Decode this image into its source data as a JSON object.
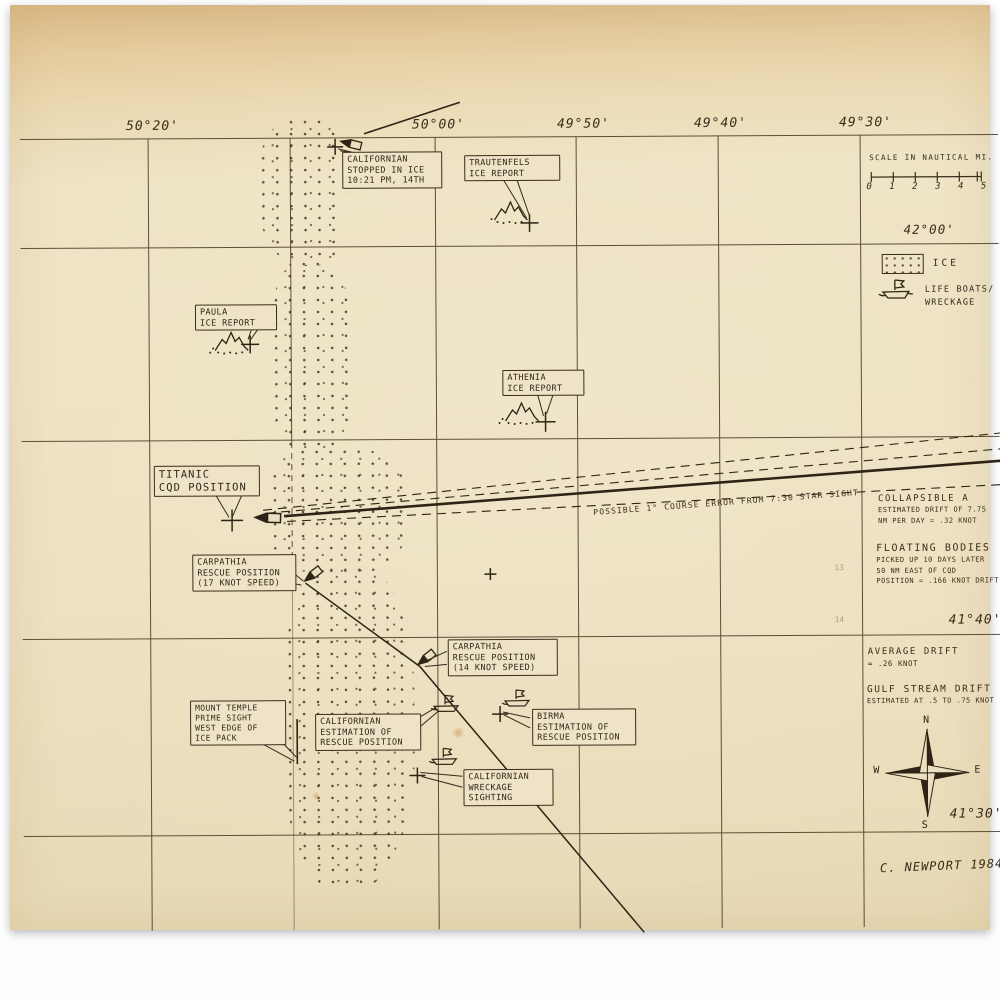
{
  "longitude_labels": [
    "50°20'",
    "50°00'",
    "49°50'",
    "49°40'",
    "49°30'"
  ],
  "latitude_labels": [
    "42°00'",
    "41°40'",
    "41°30'"
  ],
  "scale": {
    "title": "SCALE IN NAUTICAL MI.",
    "ticks": [
      "0",
      "1",
      "2",
      "3",
      "4",
      "5"
    ]
  },
  "legend": {
    "ice": "ICE",
    "lifeboats": [
      "LIFE BOATS/",
      "WRECKAGE"
    ]
  },
  "callouts": {
    "californian_stopped": [
      "CALIFORNIAN",
      "STOPPED IN ICE",
      "10:21 PM, 14TH"
    ],
    "trautenfels": [
      "TRAUTENFELS",
      "ICE REPORT"
    ],
    "paula": [
      "PAULA",
      "ICE REPORT"
    ],
    "athenia": [
      "ATHENIA",
      "ICE REPORT"
    ],
    "titanic": [
      "TITANIC",
      "CQD POSITION"
    ],
    "carpathia_17": [
      "CARPATHIA",
      "RESCUE POSITION",
      "(17 KNOT SPEED)"
    ],
    "carpathia_14": [
      "CARPATHIA",
      "RESCUE POSITION",
      "(14 KNOT SPEED)"
    ],
    "mount_temple": [
      "MOUNT TEMPLE",
      "PRIME SIGHT",
      "WEST EDGE OF",
      "ICE PACK"
    ],
    "californian_estimation": [
      "CALIFORNIAN",
      "ESTIMATION OF",
      "RESCUE POSITION"
    ],
    "birma": [
      "BIRMA",
      "ESTIMATION OF",
      "RESCUE POSITION"
    ],
    "californian_wreckage": [
      "CALIFORNIAN",
      "WRECKAGE",
      "SIGHTING"
    ]
  },
  "annotations": {
    "course_error": "POSSIBLE 1° COURSE ERROR FROM 7:30 STAR SIGHT",
    "collapsible": {
      "title": "COLLAPSIBLE A",
      "lines": [
        "ESTIMATED DRIFT OF 7.75",
        "NM PER DAY = .32 KNOT"
      ]
    },
    "floating_bodies": {
      "title": "FLOATING BODIES",
      "lines": [
        "PICKED UP 10 DAYS LATER",
        "50 NM EAST OF CQD",
        "POSITION = .166 KNOT DRIFT"
      ]
    },
    "average_drift": {
      "title": "AVERAGE DRIFT",
      "lines": [
        "= .26 KNOT"
      ]
    },
    "gulf_stream": {
      "title": "GULF STREAM DRIFT",
      "lines": [
        "ESTIMATED AT .5 TO .75 KNOT"
      ]
    },
    "pencil_marks": [
      "13",
      "14"
    ]
  },
  "compass": {
    "north": "N",
    "east": "E",
    "south": "S",
    "west": "W"
  },
  "signature": "C. NEWPORT 1984"
}
